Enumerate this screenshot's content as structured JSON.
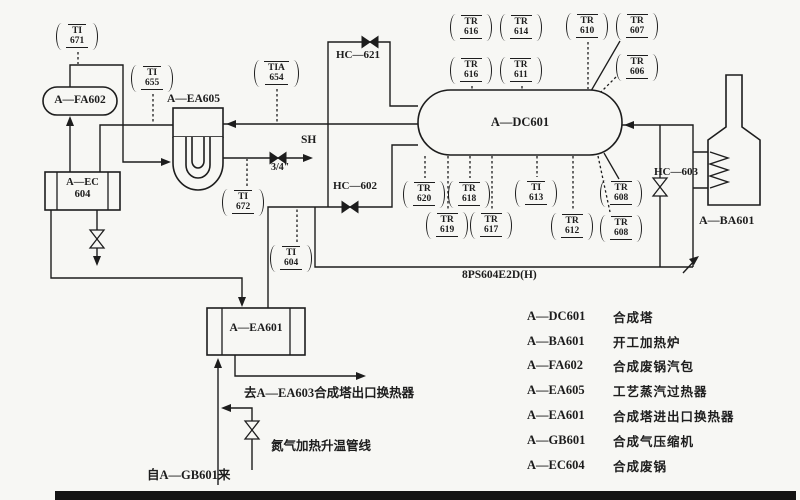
{
  "instruments": {
    "ti671": {
      "tag": "TI",
      "num": "671"
    },
    "ti655": {
      "tag": "TI",
      "num": "655"
    },
    "tia654": {
      "tag": "TIA",
      "num": "654"
    },
    "ti672": {
      "tag": "TI",
      "num": "672"
    },
    "ti604": {
      "tag": "TI",
      "num": "604"
    },
    "tr616a": {
      "tag": "TR",
      "num": "616"
    },
    "tr614": {
      "tag": "TR",
      "num": "614"
    },
    "tr610": {
      "tag": "TR",
      "num": "610"
    },
    "tr607": {
      "tag": "TR",
      "num": "607"
    },
    "tr616b": {
      "tag": "TR",
      "num": "616"
    },
    "tr611": {
      "tag": "TR",
      "num": "611"
    },
    "tr606": {
      "tag": "TR",
      "num": "606"
    },
    "tr620": {
      "tag": "TR",
      "num": "620"
    },
    "tr618": {
      "tag": "TR",
      "num": "618"
    },
    "ti613": {
      "tag": "TI",
      "num": "613"
    },
    "tr608a": {
      "tag": "TR",
      "num": "608"
    },
    "tr619": {
      "tag": "TR",
      "num": "619"
    },
    "tr617": {
      "tag": "TR",
      "num": "617"
    },
    "tr612": {
      "tag": "TR",
      "num": "612"
    },
    "tr608b": {
      "tag": "TR",
      "num": "608"
    }
  },
  "equipment": {
    "fa602": "A—FA602",
    "ec604_l1": "A—EC",
    "ec604_l2": "604",
    "ea605": "A—EA605",
    "dc601": "A—DC601",
    "ba601": "A—BA601",
    "ea601": "A—EA601"
  },
  "valves": {
    "hc621": "HC—621",
    "hc602": "HC—602",
    "hc603": "HC—603"
  },
  "labels": {
    "sh": "SH",
    "valve_size": "3/4\"",
    "line_spec": "8PS604E2D(H)",
    "to_ea603": "去A—EA603合成塔出口换热器",
    "nitrogen_line": "氮气加热升温管线",
    "from_gb601": "自A—GB601来"
  },
  "legend": [
    {
      "code": "A—DC601",
      "desc": "合成塔"
    },
    {
      "code": "A—BA601",
      "desc": "开工加热炉"
    },
    {
      "code": "A—FA602",
      "desc": "合成废锅汽包"
    },
    {
      "code": "A—EA605",
      "desc": "工艺蒸汽过热器"
    },
    {
      "code": "A—EA601",
      "desc": "合成塔进出口换热器"
    },
    {
      "code": "A—GB601",
      "desc": "合成气压缩机"
    },
    {
      "code": "A—EC604",
      "desc": "合成废锅"
    }
  ]
}
